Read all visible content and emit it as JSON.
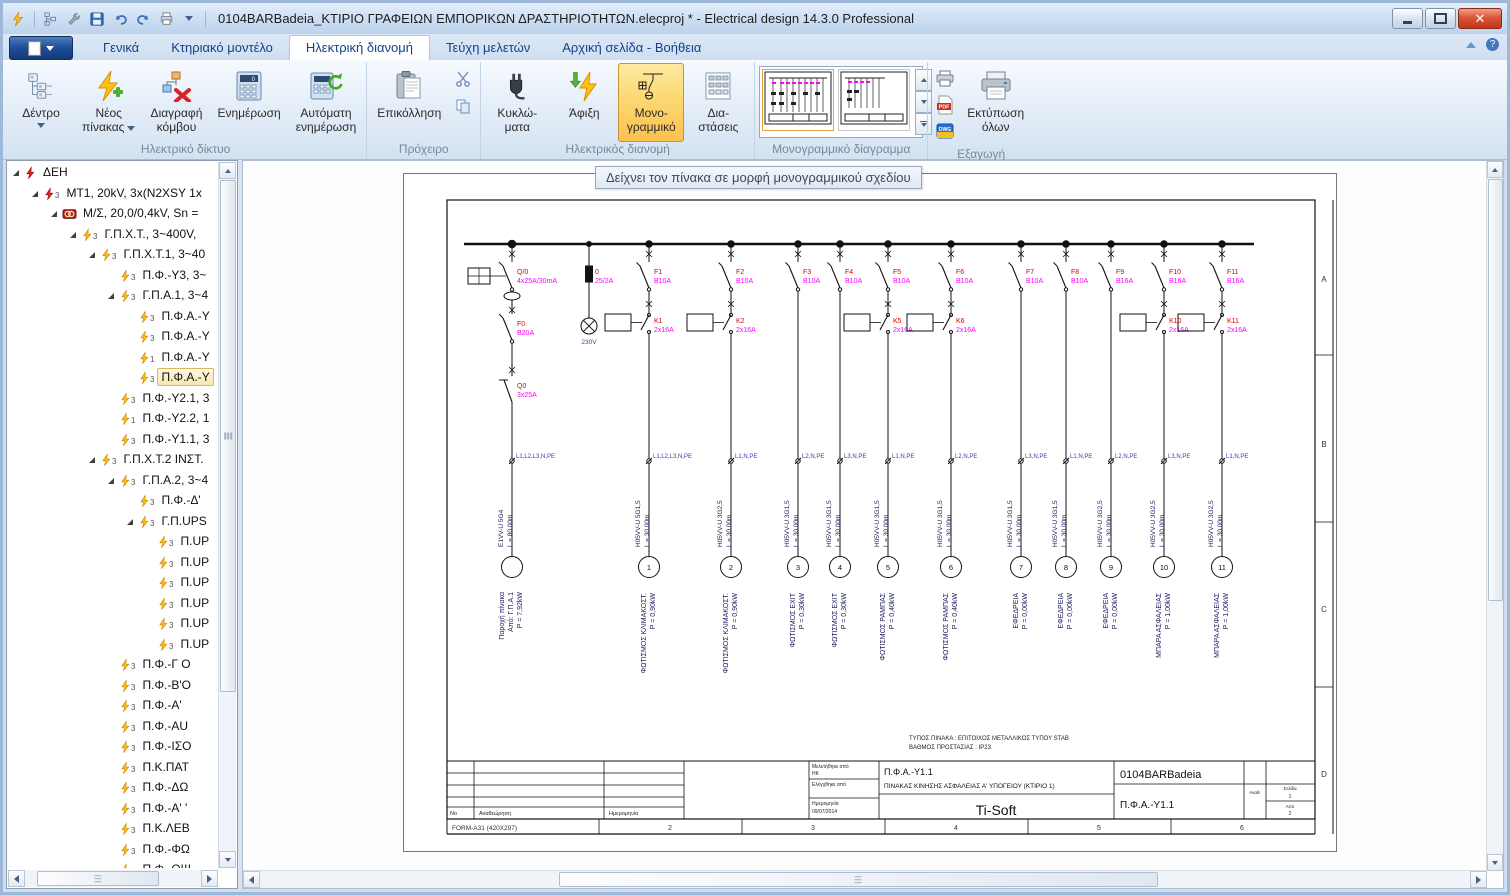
{
  "window": {
    "title": "0104BARBadeia_ΚΤΙΡΙΟ ΓΡΑΦΕΙΩΝ ΕΜΠΟΡΙΚΩΝ ΔΡΑΣΤΗΡΙΟΤΗΤΩΝ.elecproj * - Electrical design 14.3.0 Professional",
    "quick_access_icons": [
      "app-bolt",
      "tree",
      "wrench",
      "save",
      "undo",
      "redo",
      "print",
      "dropdown"
    ]
  },
  "tabs": {
    "items": [
      {
        "label": "Γενικά",
        "active": false
      },
      {
        "label": "Κτηριακό μοντέλο",
        "active": false
      },
      {
        "label": "Ηλεκτρική διανομή",
        "active": true
      },
      {
        "label": "Τεύχη μελετών",
        "active": false
      },
      {
        "label": "Αρχική σελίδα - Βοήθεια",
        "active": false
      }
    ]
  },
  "ribbon": {
    "groups": [
      {
        "label": "Ηλεκτρικό δίκτυο",
        "buttons": [
          {
            "l1": "Δέντρο",
            "l2": ""
          },
          {
            "l1": "Νέος",
            "l2": "πίνακας"
          },
          {
            "l1": "Διαγραφή",
            "l2": "κόμβου"
          },
          {
            "l1": "Ενημέρωση",
            "l2": ""
          },
          {
            "l1": "Αυτόματη",
            "l2": "ενημέρωση"
          }
        ]
      },
      {
        "label": "Πρόχειρο",
        "buttons": [
          {
            "l1": "Επικόλληση",
            "l2": ""
          }
        ]
      },
      {
        "label": "Ηλεκτρικός διανομή",
        "buttons": [
          {
            "l1": "Κυκλώ-",
            "l2": "ματα"
          },
          {
            "l1": "Άφιξη",
            "l2": ""
          },
          {
            "l1": "Μονο-",
            "l2": "γραμμικό"
          },
          {
            "l1": "Δια-",
            "l2": "στάσεις"
          }
        ]
      },
      {
        "label": "Μονογραμμικό δίαγραμμα"
      },
      {
        "label": "Εξαγωγή",
        "buttons": [
          {
            "l1": "Εκτύπωση",
            "l2": "όλων"
          }
        ]
      }
    ]
  },
  "tree": {
    "items": [
      {
        "level": 0,
        "icon": "bolt-red",
        "sub": "",
        "label": "ΔΕΗ",
        "expanded": true,
        "selected": false
      },
      {
        "level": 1,
        "icon": "bolt-red",
        "sub": "3",
        "label": "MT1, 20kV, 3x(N2XSY 1x",
        "expanded": true,
        "selected": false
      },
      {
        "level": 2,
        "icon": "transformer",
        "sub": "",
        "label": "Μ/Σ, 20,0/0,4kV, Sn =",
        "expanded": true,
        "selected": false
      },
      {
        "level": 3,
        "icon": "bolt-yellow",
        "sub": "3",
        "label": "Γ.Π.Χ.Τ., 3~400V,",
        "expanded": true,
        "selected": false
      },
      {
        "level": 4,
        "icon": "bolt-yellow",
        "sub": "3",
        "label": "Γ.Π.Χ.Τ.1, 3~40",
        "expanded": true,
        "selected": false
      },
      {
        "level": 5,
        "icon": "bolt-yellow",
        "sub": "3",
        "label": "Π.Φ.-Υ3, 3~",
        "expanded": false,
        "selected": false
      },
      {
        "level": 5,
        "icon": "bolt-yellow",
        "sub": "3",
        "label": "Γ.Π.Α.1, 3~4",
        "expanded": true,
        "selected": false
      },
      {
        "level": 6,
        "icon": "bolt-yellow",
        "sub": "3",
        "label": "Π.Φ.Α.-Υ",
        "expanded": false,
        "selected": false
      },
      {
        "level": 6,
        "icon": "bolt-yellow",
        "sub": "3",
        "label": "Π.Φ.Α.-Υ",
        "expanded": false,
        "selected": false
      },
      {
        "level": 6,
        "icon": "bolt-yellow",
        "sub": "1",
        "label": "Π.Φ.Α.-Υ",
        "expanded": false,
        "selected": false
      },
      {
        "level": 6,
        "icon": "bolt-yellow",
        "sub": "3",
        "label": "Π.Φ.Α.-Υ",
        "expanded": false,
        "selected": true
      },
      {
        "level": 5,
        "icon": "bolt-yellow",
        "sub": "3",
        "label": "Π.Φ.-Υ2.1, 3",
        "expanded": false,
        "selected": false
      },
      {
        "level": 5,
        "icon": "bolt-yellow",
        "sub": "1",
        "label": "Π.Φ.-Υ2.2, 1",
        "expanded": false,
        "selected": false
      },
      {
        "level": 5,
        "icon": "bolt-yellow",
        "sub": "3",
        "label": "Π.Φ.-Υ1.1, 3",
        "expanded": false,
        "selected": false
      },
      {
        "level": 4,
        "icon": "bolt-yellow",
        "sub": "3",
        "label": "Γ.Π.Χ.Τ.2 ΙΝΣΤ.",
        "expanded": true,
        "selected": false
      },
      {
        "level": 5,
        "icon": "bolt-yellow",
        "sub": "3",
        "label": "Γ.Π.Α.2, 3~4",
        "expanded": true,
        "selected": false
      },
      {
        "level": 6,
        "icon": "bolt-yellow",
        "sub": "3",
        "label": "Π.Φ.-Δ'",
        "expanded": false,
        "selected": false
      },
      {
        "level": 6,
        "icon": "bolt-yellow",
        "sub": "3",
        "label": "Γ.Π.UPS",
        "expanded": true,
        "selected": false
      },
      {
        "level": 7,
        "icon": "bolt-yellow",
        "sub": "3",
        "label": "Π.UP",
        "expanded": false,
        "selected": false
      },
      {
        "level": 7,
        "icon": "bolt-yellow",
        "sub": "3",
        "label": "Π.UP",
        "expanded": false,
        "selected": false
      },
      {
        "level": 7,
        "icon": "bolt-yellow",
        "sub": "3",
        "label": "Π.UP",
        "expanded": false,
        "selected": false
      },
      {
        "level": 7,
        "icon": "bolt-yellow",
        "sub": "3",
        "label": "Π.UP",
        "expanded": false,
        "selected": false
      },
      {
        "level": 7,
        "icon": "bolt-yellow",
        "sub": "3",
        "label": "Π.UP",
        "expanded": false,
        "selected": false
      },
      {
        "level": 7,
        "icon": "bolt-yellow",
        "sub": "3",
        "label": "Π.UP",
        "expanded": false,
        "selected": false
      },
      {
        "level": 5,
        "icon": "bolt-yellow",
        "sub": "3",
        "label": "Π.Φ.-Γ Ο",
        "expanded": false,
        "selected": false
      },
      {
        "level": 5,
        "icon": "bolt-yellow",
        "sub": "3",
        "label": "Π.Φ.-Β'Ο",
        "expanded": false,
        "selected": false
      },
      {
        "level": 5,
        "icon": "bolt-yellow",
        "sub": "3",
        "label": "Π.Φ.-Α'",
        "expanded": false,
        "selected": false
      },
      {
        "level": 5,
        "icon": "bolt-yellow",
        "sub": "3",
        "label": "Π.Φ.-AU",
        "expanded": false,
        "selected": false
      },
      {
        "level": 5,
        "icon": "bolt-yellow",
        "sub": "3",
        "label": "Π.Φ.-ΙΣΟ",
        "expanded": false,
        "selected": false
      },
      {
        "level": 5,
        "icon": "bolt-yellow",
        "sub": "3",
        "label": "Π.Κ.ΠΑΤ",
        "expanded": false,
        "selected": false
      },
      {
        "level": 5,
        "icon": "bolt-yellow",
        "sub": "3",
        "label": "Π.Φ.-ΔΩ",
        "expanded": false,
        "selected": false
      },
      {
        "level": 5,
        "icon": "bolt-yellow",
        "sub": "3",
        "label": "Π.Φ.-Α' '",
        "expanded": false,
        "selected": false
      },
      {
        "level": 5,
        "icon": "bolt-yellow",
        "sub": "3",
        "label": "Π.Κ.ΛΕΒ",
        "expanded": false,
        "selected": false
      },
      {
        "level": 5,
        "icon": "bolt-yellow",
        "sub": "3",
        "label": "Π.Φ.-ΦΩ",
        "expanded": false,
        "selected": false
      },
      {
        "level": 5,
        "icon": "bolt-yellow",
        "sub": "3",
        "label": "Π.Φ.-ΟΨ",
        "expanded": false,
        "selected": false
      }
    ]
  },
  "main": {
    "tooltip": "Δείχνει τον πίνακα σε μορφή μονογραμμικού σχεδίου"
  },
  "diagram": {
    "colors": {
      "device_name": "#e00000",
      "rating": "#ff00ff",
      "phase": "#3b3bb0",
      "cable": "#1b1b5e"
    },
    "incoming": {
      "x": 108,
      "rcd": {
        "name": "Q/0",
        "rating": "4x25A/30mA"
      },
      "breaker": {
        "name": "F0",
        "rating": "B20A"
      },
      "switch": {
        "name": "Q0",
        "rating": "3x25A"
      },
      "phases": "L1,L2,L3,N,PE",
      "cable": "E1VV-U 5G4",
      "length": "L = 80,00m",
      "load_name": "Παροχή πίνακα",
      "load_from": "Από: Γ.Π.Α.1",
      "load_power": "P = 7,92kW"
    },
    "indicator": {
      "x": 185,
      "fuse_name": "0",
      "fuse_rating": "25/2A",
      "lamp": "230V"
    },
    "circuits": [
      {
        "x": 245,
        "name": "F1",
        "rating": "B10A",
        "k_name": "K1",
        "k_rating": "2x16A",
        "phases": "L1,L2,L3,N,PE",
        "cable": "H05VV-U 5G1,5",
        "length": "L = 30,00m",
        "no": "1",
        "load": "ΦΩΤΙΣΜΟΣ ΚΛΙΜΑΚΟΣΤ.",
        "power": "P = 0,90kW"
      },
      {
        "x": 327,
        "name": "F2",
        "rating": "B10A",
        "k_name": "K2",
        "k_rating": "2x16A",
        "phases": "L1,N,PE",
        "cable": "H05VV-U 3G2,5",
        "length": "L = 30,00m",
        "no": "2",
        "load": "ΦΩΤΙΣΜΟΣ ΚΛΙΜΑΚΟΣΤ.",
        "power": "P = 0,90kW"
      },
      {
        "x": 394,
        "name": "F3",
        "rating": "B10A",
        "k_name": "",
        "k_rating": "",
        "phases": "L2,N,PE",
        "cable": "H05VV-U 3G1,5",
        "length": "L = 30,00m",
        "no": "3",
        "load": "ΦΩΤΙΣΜΟΣ EXIT",
        "power": "P = 0,30kW"
      },
      {
        "x": 436,
        "name": "F4",
        "rating": "B10A",
        "k_name": "",
        "k_rating": "",
        "phases": "L3,N,PE",
        "cable": "H05VV-U 3G1,5",
        "length": "L = 30,00m",
        "no": "4",
        "load": "ΦΩΤΙΣΜΟΣ EXIT",
        "power": "P = 0,30kW"
      },
      {
        "x": 484,
        "name": "F5",
        "rating": "B10A",
        "k_name": "K5",
        "k_rating": "2x16A",
        "phases": "L1,N,PE",
        "cable": "H05VV-U 3G1,5",
        "length": "L = 30,00m",
        "no": "5",
        "load": "ΦΩΤΙΣΜΟΣ ΡΑΜΠΑΣ",
        "power": "P = 0,40kW"
      },
      {
        "x": 547,
        "name": "F6",
        "rating": "B10A",
        "k_name": "K6",
        "k_rating": "2x16A",
        "phases": "L2,N,PE",
        "cable": "H05VV-U 3G1,5",
        "length": "L = 30,00m",
        "no": "6",
        "load": "ΦΩΤΙΣΜΟΣ ΡΑΜΠΑΣ",
        "power": "P = 0,40kW"
      },
      {
        "x": 617,
        "name": "F7",
        "rating": "B10A",
        "k_name": "",
        "k_rating": "",
        "phases": "L3,N,PE",
        "cable": "H05VV-U 3G1,5",
        "length": "L = 30,00m",
        "no": "7",
        "load": "ΕΦΕΔΡΕΙΑ",
        "power": "P = 0,00kW"
      },
      {
        "x": 662,
        "name": "F8",
        "rating": "B10A",
        "k_name": "",
        "k_rating": "",
        "phases": "L1,N,PE",
        "cable": "H05VV-U 3G1,5",
        "length": "L = 30,00m",
        "no": "8",
        "load": "ΕΦΕΔΡΕΙΑ",
        "power": "P = 0,00kW"
      },
      {
        "x": 707,
        "name": "F9",
        "rating": "B16A",
        "k_name": "",
        "k_rating": "",
        "phases": "L2,N,PE",
        "cable": "H05VV-U 3G2,5",
        "length": "L = 30,00m",
        "no": "9",
        "load": "ΕΦΕΔΡΕΙΑ",
        "power": "P = 0,00kW"
      },
      {
        "x": 760,
        "name": "F10",
        "rating": "B16A",
        "k_name": "K10",
        "k_rating": "2x16A",
        "phases": "L3,N,PE",
        "cable": "H05VV-U 3G2,5",
        "length": "L = 30,00m",
        "no": "10",
        "load": "ΜΠΑΡΑ ΑΣΦΑΛΕΙΑΣ",
        "power": "P = 1,00kW"
      },
      {
        "x": 818,
        "name": "F11",
        "rating": "B16A",
        "k_name": "K11",
        "k_rating": "2x16A",
        "phases": "L1,N,PE",
        "cable": "H05VV-U 3G2,5",
        "length": "L = 30,00m",
        "no": "11",
        "load": "ΜΠΑΡΑ ΑΣΦΑΛΕΙΑΣ",
        "power": "P = 1,00kW"
      }
    ],
    "notes": [
      "ΤΥΠΟΣ ΠΙΝΑΚΑ : ΕΠΙΤΟΙΧΟΣ ΜΕΤΑΛΛΙΚΟΣ ΤΥΠΟΥ STAB",
      "ΒΑΘΜΟΣ ΠΡΟΣΤΑΣΙΑΣ : IP23"
    ],
    "frame": {
      "zones": [
        "A",
        "B",
        "C",
        "D"
      ],
      "ruler_numbers": [
        "2",
        "3",
        "4",
        "5",
        "6"
      ],
      "form": "FORM-A31 (420X297)"
    },
    "titleblock": {
      "rev_no": "No",
      "rev_label": "Αναθεώρηση",
      "rev_date": "Ημερομηνία",
      "designed_label": "Μελετήθηκε από",
      "designed_by": "ΗΚ",
      "checked_label": "Ελέγχθηκε από",
      "date_label": "Ημερομηνία",
      "date": "09/07/2014",
      "panel_code": "Π.Φ.Α.-Υ1.1",
      "panel_title": "ΠΙΝΑΚΑΣ ΚΙΝΗΣΗΣ ΑΣΦΑΛΕΙΑΣ Α' ΥΠΟΓΕΙΟΥ (ΚΤΙΡΙΟ 1)",
      "company": "Ti-Soft",
      "project_code": "0104BARBadeia",
      "drawing_code": "Π.Φ.Α.-Υ1.1",
      "revcol_label": "Αναθ.",
      "page_label": "Σελίδα",
      "page": "1",
      "of_label": "Από",
      "of": "2"
    }
  }
}
